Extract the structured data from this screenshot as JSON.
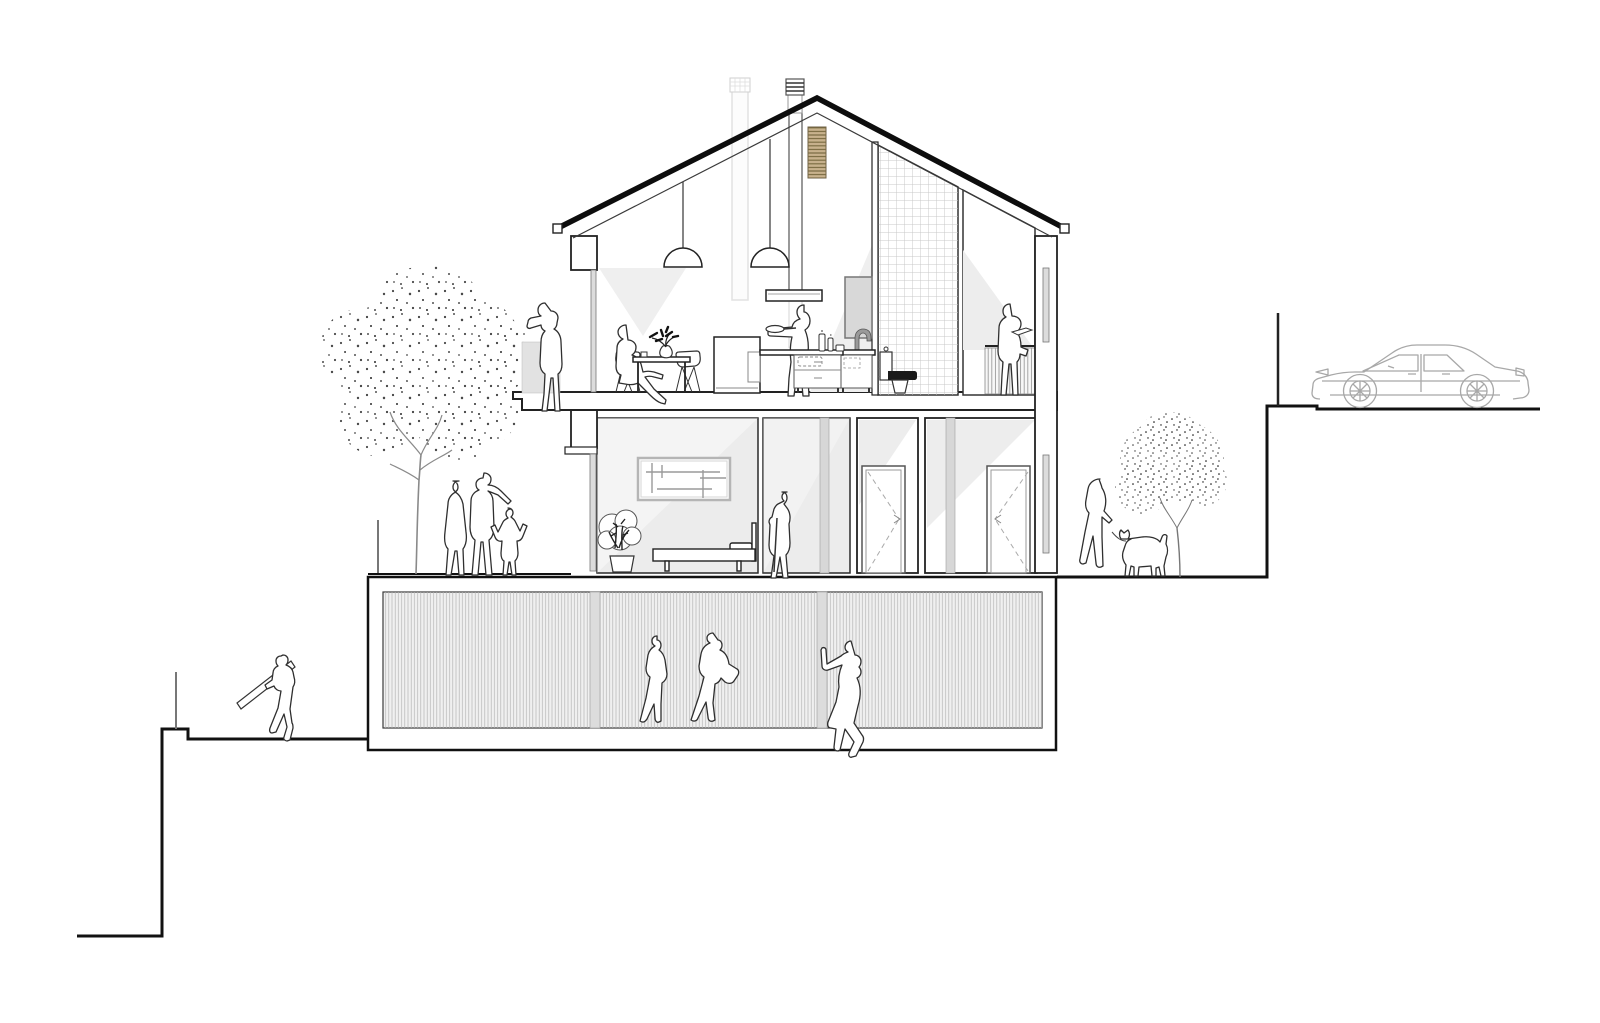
{
  "meta": {
    "title": "Residential building cross-section drawing",
    "description": "Black-and-white architectural section through a three-level gabled house set into a stepped hillside, populated with human silhouettes, two stippled trees and a parked car on the upper street."
  },
  "colors": {
    "paper": "#ffffff",
    "line": "#111111",
    "room_shade": "#ececec",
    "doorway_shade": "#d7d7d7",
    "glass": "#dcdcdc",
    "terrace_block": "#e2e2e2",
    "mirror": "#d8d8d8",
    "hatch_bg": "#f0f0f0",
    "vent_tan": "#c8b28d",
    "toilet_seat": "#1a1a1a",
    "car_line": "#a8a8a8"
  },
  "scene": {
    "exterior": [
      "stepped-terrain",
      "large-stippled-tree",
      "small-stippled-tree",
      "parked-car",
      "street-pole",
      "terrace-posts"
    ],
    "figures": [
      "photographer-on-terrace",
      "seated-diner",
      "cook-at-island",
      "reader-at-balcony",
      "walking-family",
      "elderly-man-with-cane",
      "basement-woman-1",
      "basement-woman-2",
      "basement-man-leaning",
      "plank-carrier",
      "dog-walker",
      "dog"
    ],
    "top_floor": [
      "gable-roof",
      "chimney-flues",
      "wood-slat-vent",
      "pendant-lamps",
      "extractor-hood",
      "dining-table",
      "dining-chairs",
      "kitchen-island",
      "vanity-sink",
      "wall-mirror",
      "tiled-wall",
      "toilet",
      "balcony-railing"
    ],
    "middle_floor": [
      "bedroom",
      "picture-frame",
      "potted-plant",
      "bed",
      "hallway",
      "doorway-strips",
      "interior-door-left",
      "interior-door-right"
    ],
    "basement": [
      "slatted-facade",
      "facade-seams"
    ]
  }
}
